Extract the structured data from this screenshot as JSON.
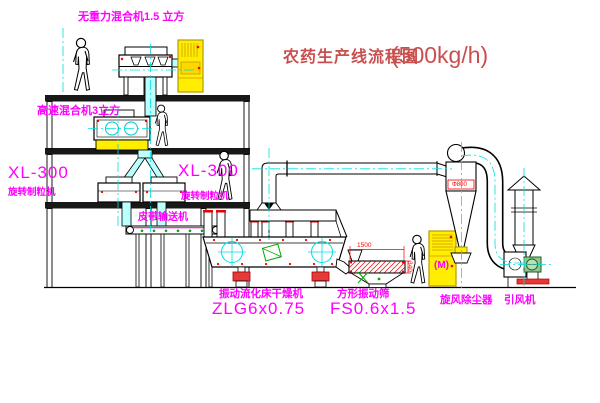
{
  "title": {
    "main": "农药生产线流程图",
    "capacity": "(500kg/h)"
  },
  "labels": {
    "top_mixer": "无重力混合机1.5 立方",
    "high_speed_mixer": "高速混合机3立方",
    "granulator_left_model": "XL-300",
    "granulator_left_name": "旋转制粒机",
    "granulator_right_model": "XL-300",
    "granulator_right_name": "旋转制粒机",
    "belt_conveyor": "皮带输送机",
    "dryer_name": "振动流化床干燥机",
    "dryer_model": "ZLG6x0.75",
    "sieve_name": "方形振动筛",
    "sieve_model": "FS0.6x1.5",
    "cyclone": "旋风除尘器",
    "fan": "引风机",
    "cabinet_motor": "(M)"
  },
  "dimensions": {
    "sieve_length": "1500",
    "sieve_height": "340",
    "cyclone_diameter": "Φ800"
  },
  "colors": {
    "label_magenta": "#ff00ff",
    "title_red": "#c94f4f",
    "dimension_red": "#ff0000",
    "centerline_cyan": "#00e0e0",
    "cabinet_yellow": "#ffee00",
    "machine_green": "#00aa00",
    "line_black": "#000000"
  }
}
